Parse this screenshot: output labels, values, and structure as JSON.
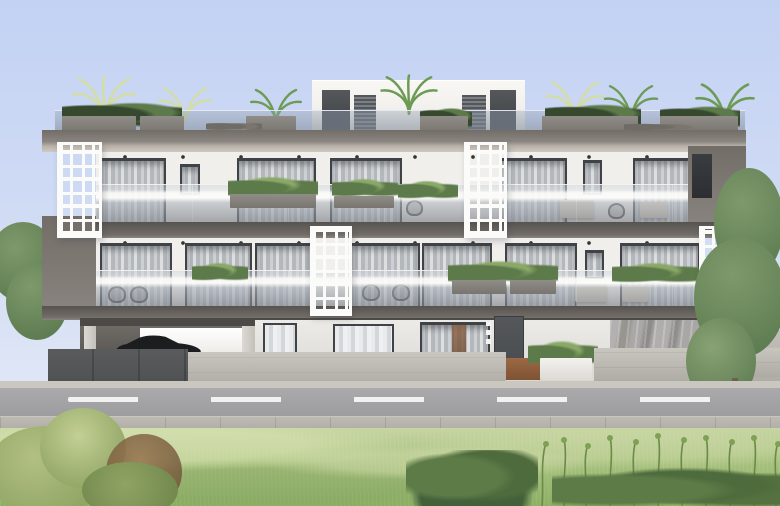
{
  "scene": {
    "type": "architectural-exterior-render",
    "subject": "modern three-storey apartment building, street-front elevation",
    "sky": "clear pale blue",
    "building": {
      "storeys": 3,
      "rooftop": {
        "penthouse_volume": "white box with two dark doors and two louvered panels",
        "terrace": "glass railing with gray planters, palms and shrubs, lounge chairs"
      },
      "facade": "white walls with dark gray slab bands",
      "decorative_screens": {
        "style": "white perforated lattice panels",
        "count": 4
      },
      "balconies": "recessed with frameless glass balustrades, sheer-curtained sliding doors, planters and outdoor chairs",
      "ground_floor": {
        "left": "covered pilotis parking with black car",
        "center": "entrance with dark door, signage dots, white planter, terracotta walkway",
        "right": "gray marble feature wall and side driveway"
      },
      "street_walls": "dark gray panel fence and light concrete walls"
    },
    "street": {
      "road": "asphalt with white dashed center line",
      "dash_count": 5,
      "sidewalk": "light paved strip with joints"
    },
    "vegetation": [
      "rooftop palms (pale and green)",
      "balcony planter greenery",
      "tree behind left fence",
      "large tree at right building corner",
      "foreground meadow grass",
      "wild yellow-green bushes left",
      "reddish shrub left",
      "dark green bush center",
      "tall wispy plants right"
    ]
  },
  "palette": {
    "sky-top": "#c3d1f3",
    "sky-mid": "#cfdbf4",
    "sky-low": "#e3e9f6",
    "fascia-darker": "#57534f",
    "fascia-dark": "#726d67",
    "fascia-mid": "#8a8580",
    "fascia-light": "#b8b1a9",
    "facade": "#f1efec",
    "facade-shade": "#d9d6d1",
    "soffit": "#e9e7e3",
    "downlight": "#37352f",
    "frame": "#3f4246",
    "curtain-a": "#cdd0d3",
    "curtain-b": "#b4b8bd",
    "curtain-c": "#dcdedf",
    "lattice": "#fbfbf9",
    "planter": "#908d88",
    "planter-dark": "#78756f",
    "leaf-dark": "#36492f",
    "leaf-mid": "#5d7a4a",
    "leaf-light": "#8aa968",
    "palm-pale": "#d3dda4",
    "palm-green": "#6d9b55",
    "tree-green": "#7e9a6c",
    "tree-dark": "#5f7d52",
    "concrete": "#c9c6c0",
    "concrete-dark": "#aeaba5",
    "fence-dark": "#595b5d",
    "marble": "#a9a7a5",
    "terracotta": "#9c6a44",
    "door": "#4a4d4f",
    "car": "#1b1d1f",
    "beige": "#cfc5b4",
    "asphalt": "#9d9da0",
    "asphalt-light": "#aaaaac",
    "dash": "#f2f2f0",
    "pavement": "#b2afa8",
    "pavement-l": "#bdbab4",
    "curb": "#cac7c1",
    "grass-back": "#c6d4a2",
    "grass-mid": "#a9c280",
    "grass-front": "#8db064",
    "bush-yellow": "#b2c083",
    "bush-olive": "#8fa463",
    "bush-red": "#97744f",
    "bush-dark": "#4e6b3d",
    "stem": "#6a8a48"
  }
}
